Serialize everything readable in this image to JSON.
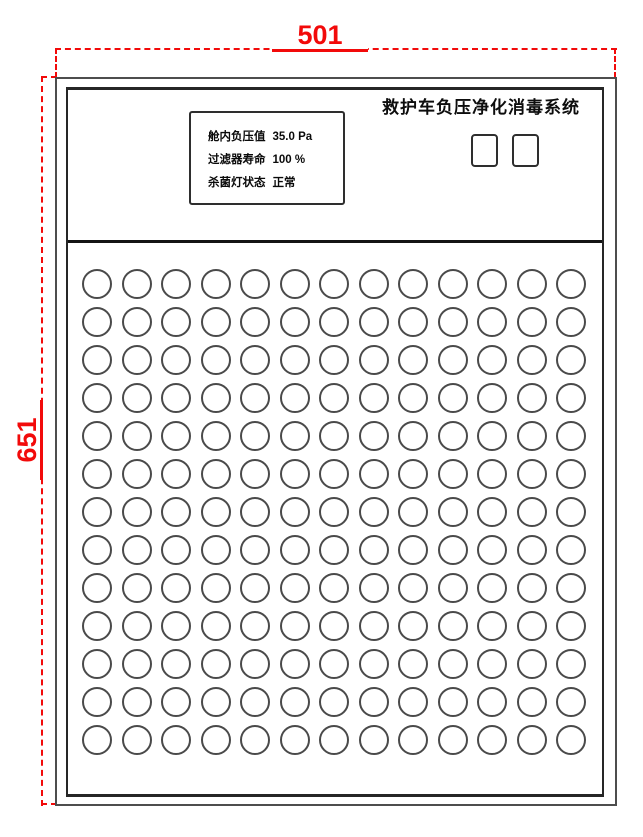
{
  "dimension_annotations": {
    "width_label": "501",
    "height_label": "651",
    "color": "#f20a0a"
  },
  "panel": {
    "title": "救护车负压净化消毒系统",
    "display": {
      "lines": [
        {
          "label": "舱内负压值",
          "value": "35.0 Pa"
        },
        {
          "label": "过滤器寿命",
          "value": "100 %"
        },
        {
          "label": "杀菌灯状态",
          "value": "正常"
        }
      ]
    },
    "buttons": {
      "count": 2
    },
    "vent_grid": {
      "rows": 13,
      "columns": 13
    }
  }
}
